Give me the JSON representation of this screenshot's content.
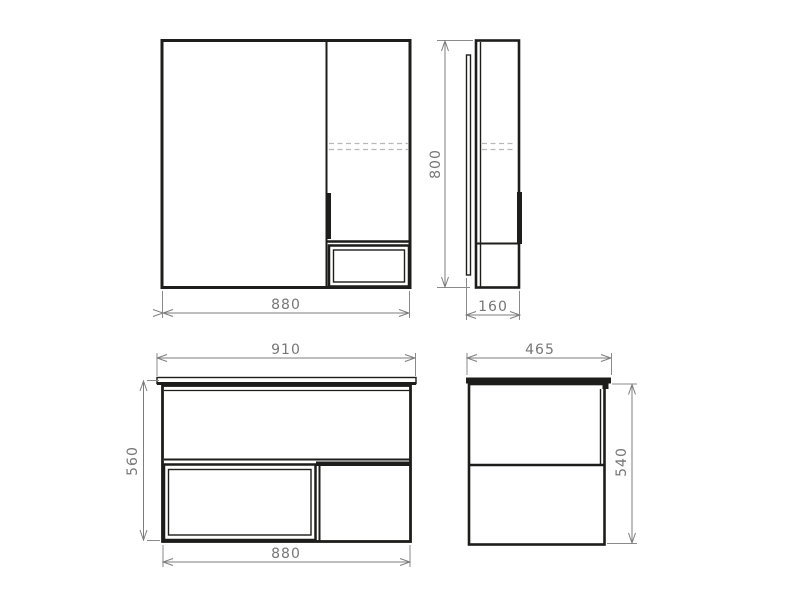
{
  "drawing": {
    "title": "bathroom-furniture-dimension-drawing",
    "colors": {
      "background": "#ffffff",
      "body_line": "#1d1d1b",
      "dimension_line": "#7d7d7d",
      "dimension_text": "#767676",
      "dashed_shelf_line": "#b8b8b8"
    },
    "views": {
      "mirror_front": {
        "name": "mirror-cabinet-front-view",
        "width_label": "880"
      },
      "mirror_side": {
        "name": "mirror-cabinet-side-view",
        "height_label": "800",
        "depth_label": "160"
      },
      "vanity_front": {
        "name": "vanity-unit-front-view",
        "countertop_width_label": "910",
        "height_label": "560",
        "body_width_label": "880"
      },
      "vanity_side": {
        "name": "vanity-unit-side-view",
        "depth_label": "465",
        "height_label": "540"
      }
    }
  },
  "dimensions": {
    "mirror_front_width": "880",
    "mirror_side_height": "800",
    "mirror_side_depth": "160",
    "vanity_countertop_width": "910",
    "vanity_front_height": "560",
    "vanity_body_width": "880",
    "vanity_side_depth": "465",
    "vanity_side_height": "540"
  }
}
